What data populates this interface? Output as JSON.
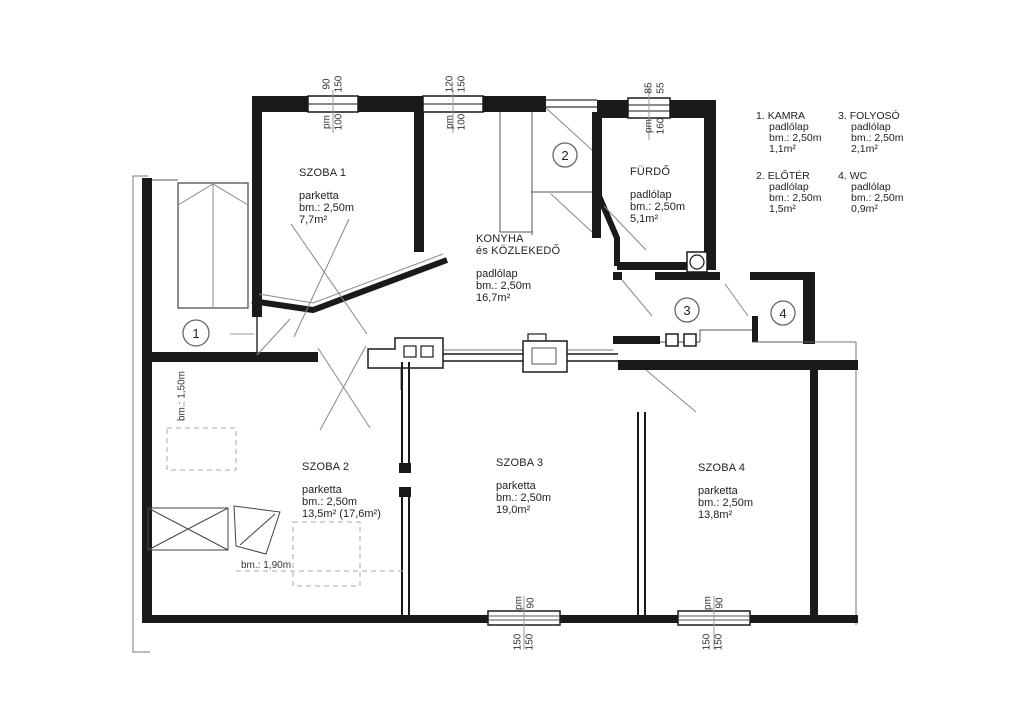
{
  "rooms": {
    "szoba1": {
      "name": "SZOBA 1",
      "floor": "parketta",
      "height": "bm.: 2,50m",
      "area": "7,7m²"
    },
    "szoba2": {
      "name": "SZOBA 2",
      "floor": "parketta",
      "height": "bm.: 2,50m",
      "area": "13,5m² (17,6m²)"
    },
    "szoba3": {
      "name": "SZOBA 3",
      "floor": "parketta",
      "height": "bm.: 2,50m",
      "area": "19,0m²"
    },
    "szoba4": {
      "name": "SZOBA 4",
      "floor": "parketta",
      "height": "bm.: 2,50m",
      "area": "13,8m²"
    },
    "konyha": {
      "name": "KONYHA",
      "name2": "és KÖZLEKEDŐ",
      "floor": "padlólap",
      "height": "bm.: 2,50m",
      "area": "16,7m²"
    },
    "furdo": {
      "name": "FÜRDŐ",
      "floor": "padlólap",
      "height": "bm.: 2,50m",
      "area": "5,1m²"
    }
  },
  "legend": {
    "items": [
      {
        "num": "1.",
        "name": "KAMRA",
        "floor": "padlólap",
        "height": "bm.: 2,50m",
        "area": "1,1m²"
      },
      {
        "num": "2.",
        "name": "ELŐTÉR",
        "floor": "padlólap",
        "height": "bm.: 2,50m",
        "area": "1,5m²"
      },
      {
        "num": "3.",
        "name": "FOLYOSÓ",
        "floor": "padlólap",
        "height": "bm.: 2,50m",
        "area": "2,1m²"
      },
      {
        "num": "4.",
        "name": "WC",
        "floor": "padlólap",
        "height": "bm.: 2,50m",
        "area": "0,9m²"
      }
    ]
  },
  "markers": {
    "kamra": "1",
    "eloter": "2",
    "folyoso": "3",
    "wc": "4"
  },
  "dims": {
    "w1a": "90",
    "w1b": "150",
    "w1c": "pm",
    "w1d": "100",
    "w2a": "120",
    "w2b": "150",
    "w2c": "pm",
    "w2d": "100",
    "w3a": "85",
    "w3b": "55",
    "w3c": "pm",
    "w3d": "160",
    "b1a": "pm",
    "b1b": "90",
    "b1c": "150",
    "b1d": "150",
    "b2a": "pm",
    "b2b": "90",
    "b2c": "150",
    "b2d": "150",
    "niche": "bm.: 1,50m",
    "bed": "bm.: 1,90m"
  },
  "colors": {
    "wall": "#1a1a1a",
    "thin": "#555",
    "light": "#999"
  }
}
